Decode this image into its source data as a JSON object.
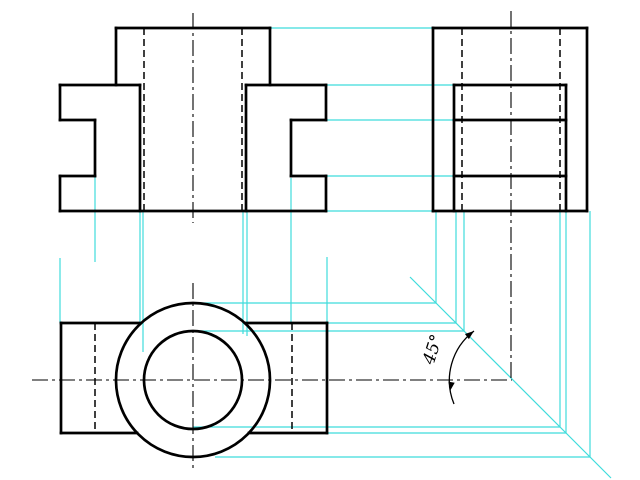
{
  "canvas": {
    "width": 640,
    "height": 480,
    "background": "#ffffff"
  },
  "colors": {
    "outline": "#000000",
    "projection": "#3fdcdc",
    "annotation": "#000000"
  },
  "views": {
    "front_view": {
      "solid": [
        [
          116,
          28,
          270,
          28
        ],
        [
          116,
          28,
          116,
          85
        ],
        [
          270,
          28,
          270,
          85
        ],
        [
          60,
          85,
          140,
          85
        ],
        [
          246,
          85,
          326,
          85
        ],
        [
          60,
          85,
          60,
          120
        ],
        [
          326,
          85,
          326,
          120
        ],
        [
          60,
          120,
          95,
          120
        ],
        [
          291,
          120,
          326,
          120
        ],
        [
          95,
          120,
          95,
          176
        ],
        [
          291,
          120,
          291,
          176
        ],
        [
          60,
          176,
          95,
          176
        ],
        [
          291,
          176,
          326,
          176
        ],
        [
          60,
          176,
          60,
          211
        ],
        [
          326,
          176,
          326,
          211
        ],
        [
          60,
          211,
          326,
          211
        ],
        [
          140,
          85,
          140,
          211
        ],
        [
          246,
          85,
          246,
          211
        ]
      ],
      "hidden": [
        [
          144,
          28,
          144,
          211
        ],
        [
          242,
          28,
          242,
          211
        ]
      ],
      "center": [
        [
          193,
          13,
          193,
          223
        ]
      ]
    },
    "side_view": {
      "solid": [
        [
          433,
          28,
          587,
          28
        ],
        [
          433,
          28,
          433,
          211
        ],
        [
          587,
          28,
          587,
          211
        ],
        [
          433,
          211,
          587,
          211
        ],
        [
          454,
          85,
          454,
          211
        ],
        [
          566,
          85,
          566,
          211
        ],
        [
          454,
          85,
          566,
          85
        ],
        [
          454,
          120,
          566,
          120
        ],
        [
          454,
          176,
          566,
          176
        ]
      ],
      "hidden": [
        [
          462,
          28,
          462,
          211
        ],
        [
          560,
          28,
          560,
          211
        ]
      ],
      "center": [
        [
          511,
          11,
          511,
          379
        ]
      ]
    },
    "top_view": {
      "solid": [
        [
          61,
          323,
          61,
          433
        ],
        [
          327,
          323,
          327,
          433
        ],
        [
          61,
          323,
          140,
          323
        ],
        [
          246,
          323,
          327,
          323
        ],
        [
          61,
          433,
          137,
          433
        ],
        [
          249,
          433,
          327,
          433
        ]
      ],
      "circles": [
        {
          "cx": 193,
          "cy": 380,
          "r": 77
        },
        {
          "cx": 193,
          "cy": 380,
          "r": 49
        }
      ],
      "hidden": [
        [
          95,
          323,
          95,
          433
        ],
        [
          292,
          323,
          292,
          433
        ]
      ],
      "center": [
        [
          193,
          283,
          193,
          472
        ],
        [
          32,
          380,
          512,
          380
        ]
      ]
    }
  },
  "projection_lines": {
    "miter_line": [
      410,
      277,
      611,
      478
    ],
    "segments": [
      [
        270,
        28,
        433,
        28
      ],
      [
        326,
        85,
        454,
        85
      ],
      [
        326,
        120,
        454,
        120
      ],
      [
        326,
        176,
        454,
        176
      ],
      [
        326,
        211,
        433,
        211
      ],
      [
        60,
        258,
        60,
        323
      ],
      [
        95,
        177,
        95,
        262
      ],
      [
        140,
        211,
        140,
        322
      ],
      [
        143,
        211,
        143,
        352
      ],
      [
        243,
        211,
        243,
        334
      ],
      [
        247,
        211,
        247,
        336
      ],
      [
        291,
        178,
        291,
        323
      ],
      [
        327,
        257,
        327,
        331
      ],
      [
        193,
        303,
        436,
        303
      ],
      [
        436,
        211,
        436,
        303
      ],
      [
        327,
        323,
        456,
        323
      ],
      [
        456,
        211,
        456,
        323
      ],
      [
        193,
        331,
        464,
        331
      ],
      [
        464,
        211,
        464,
        331
      ],
      [
        193,
        427,
        560,
        427
      ],
      [
        560,
        211,
        560,
        427
      ],
      [
        327,
        433,
        566,
        433
      ],
      [
        566,
        211,
        566,
        433
      ],
      [
        215,
        457,
        590,
        457
      ],
      [
        590,
        211,
        590,
        457
      ]
    ]
  },
  "annotation": {
    "label": "45°",
    "label_x": 438,
    "label_y": 351,
    "label_rotation": -72,
    "font_size": 17,
    "arc_path": "M 454 404 A 62 62 0 0 1 474 331",
    "arrows": [
      {
        "x": 474,
        "y": 331,
        "angle": -38
      },
      {
        "x": 450,
        "y": 391,
        "angle": 100
      }
    ]
  }
}
